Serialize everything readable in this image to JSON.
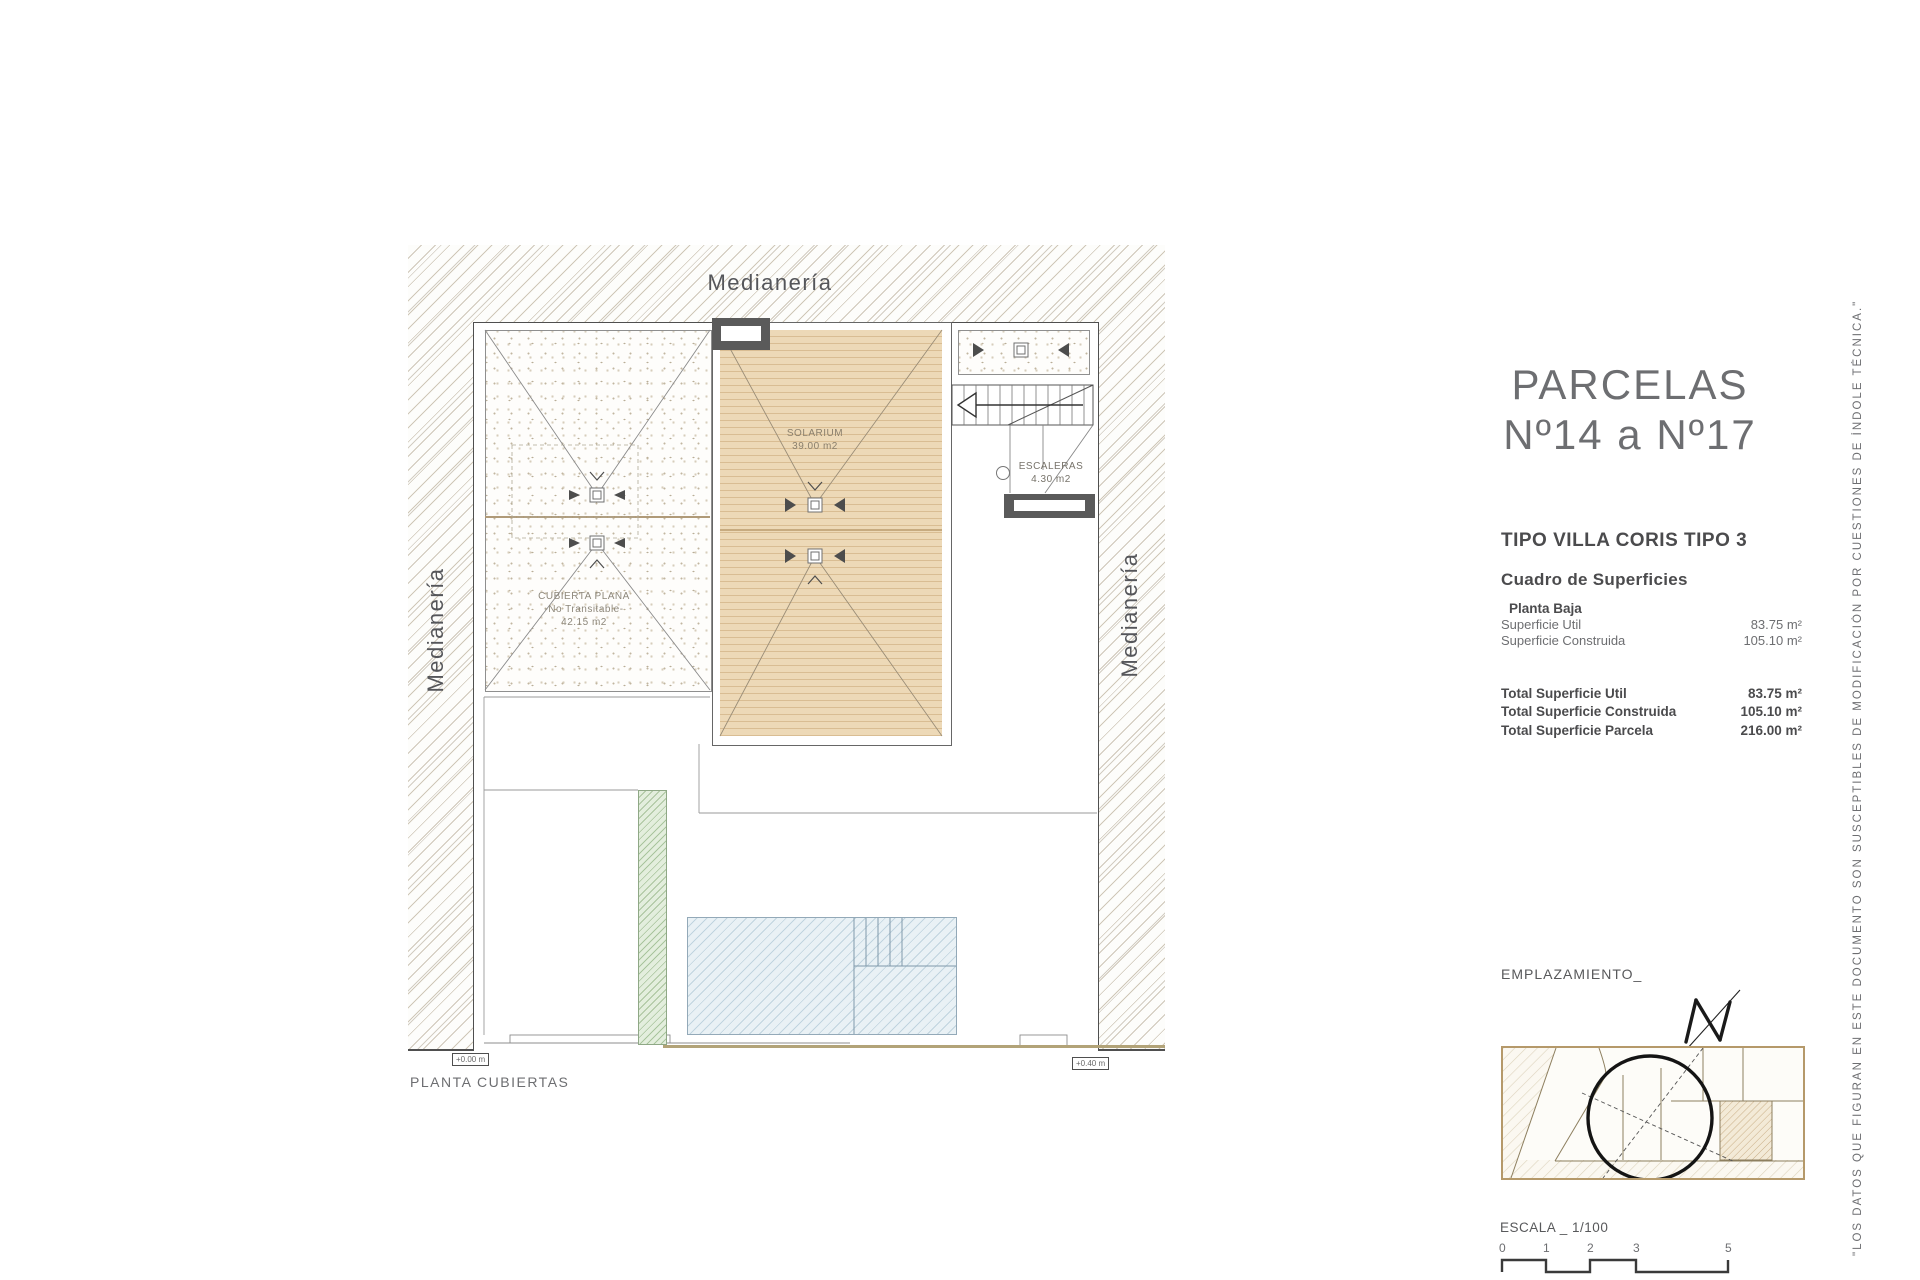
{
  "plan": {
    "caption": "PLANTA CUBIERTAS",
    "party_wall_top": "Medianería",
    "party_wall_left": "Medianería",
    "party_wall_right": "Medianería",
    "flat_roof": {
      "line1": "CUBIERTA PLANA",
      "line2": "-No Transitable-",
      "line3": "42.15 m2"
    },
    "solarium": {
      "name": "SOLARIUM",
      "area": "39.00 m2"
    },
    "stairs": {
      "name": "ESCALERAS",
      "area": "4.30 m2"
    },
    "level_marker_left": "+0.00 m",
    "level_marker_right": "+0.40 m"
  },
  "panel": {
    "title_line1": "PARCELAS",
    "title_line2": "Nº14 a Nº17",
    "type_heading": "TIPO VILLA CORIS TIPO 3",
    "table_title": "Cuadro de Superficies",
    "section": "Planta Baja",
    "rows": [
      {
        "label": "Superficie Util",
        "value": "83.75 m²"
      },
      {
        "label": "Superficie Construida",
        "value": "105.10 m²"
      }
    ],
    "totals": [
      {
        "label": "Total Superficie Util",
        "value": "83.75 m²"
      },
      {
        "label": "Total Superficie Construida",
        "value": "105.10 m²"
      },
      {
        "label": "Total Superficie Parcela",
        "value": "216.00 m²"
      }
    ]
  },
  "location": {
    "label": "EMPLAZAMIENTO_",
    "north": "N"
  },
  "scale": {
    "label": "ESCALA _ 1/100",
    "ticks": [
      "0",
      "1",
      "2",
      "3",
      "5"
    ]
  },
  "disclaimer": "\"LOS DATOS QUE FIGURAN EN ESTE DOCUMENTO SON SUSCEPTIBLES DE MODIFICACIÓN POR CUESTIONES DE ÍNDOLE TÉCNICA.\"",
  "colors": {
    "accent_tan": "#b5996a",
    "solarium_fill": "#e9d6b4",
    "pool_fill": "#dfeaf1",
    "green_fill": "#cfe0c5",
    "chimney": "#5a5a5a",
    "ink": "#58595b",
    "title_gray": "#6d6e71"
  }
}
